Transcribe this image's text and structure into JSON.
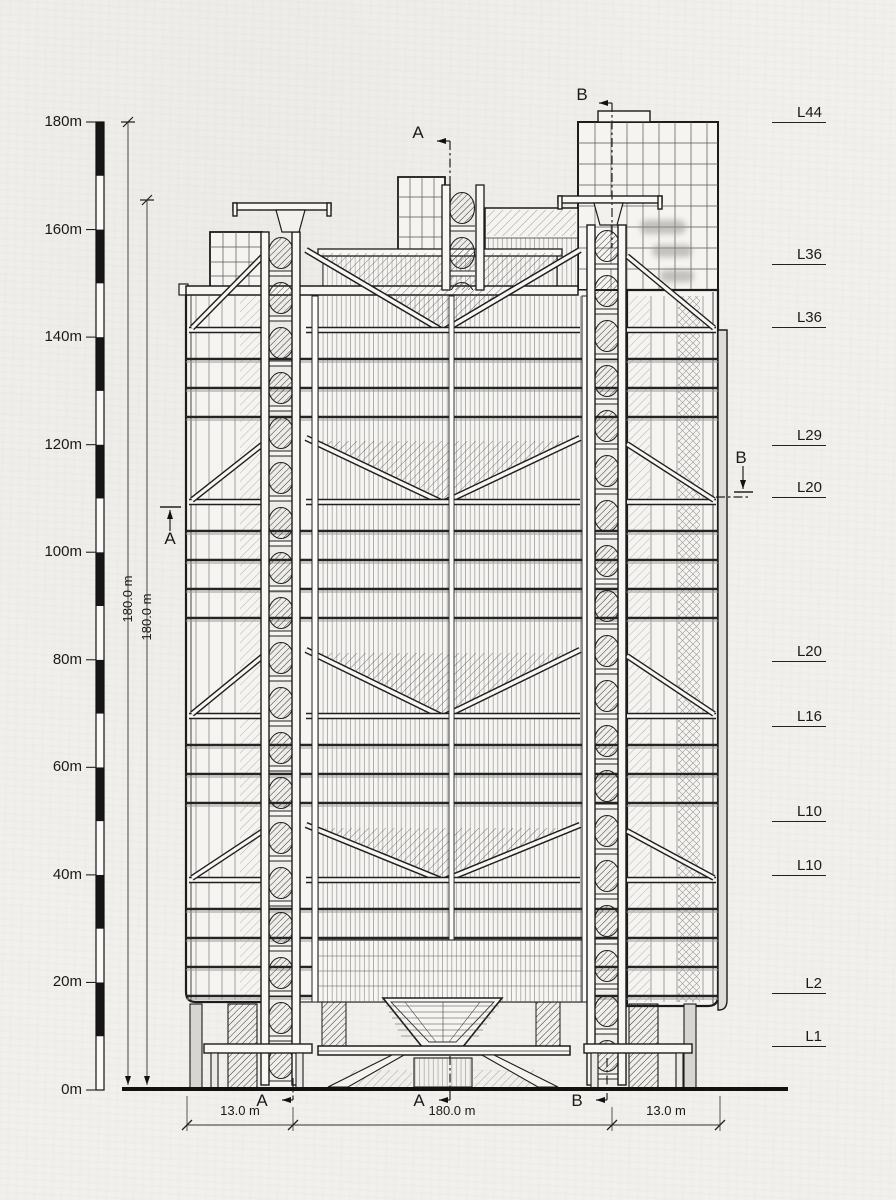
{
  "drawing": {
    "type": "architectural-elevation",
    "scale_bar": {
      "unit": "m",
      "max_m": 180,
      "band_m": 10,
      "labels": [
        {
          "text": "180m",
          "m": 180
        },
        {
          "text": "160m",
          "m": 160
        },
        {
          "text": "140m",
          "m": 140
        },
        {
          "text": "120m",
          "m": 120
        },
        {
          "text": "100m",
          "m": 100
        },
        {
          "text": "80m",
          "m": 80
        },
        {
          "text": "60m",
          "m": 60
        },
        {
          "text": "40m",
          "m": 40
        },
        {
          "text": "20m",
          "m": 20
        },
        {
          "text": "0m",
          "m": 0
        }
      ]
    },
    "height_dimensions": [
      {
        "text": "180.0 m"
      },
      {
        "text": "180.0 m"
      }
    ],
    "level_labels": [
      {
        "text": "L44",
        "y_px": 124
      },
      {
        "text": "L36",
        "y_px": 266
      },
      {
        "text": "L36",
        "y_px": 329
      },
      {
        "text": "L29",
        "y_px": 447
      },
      {
        "text": "L20",
        "y_px": 499
      },
      {
        "text": "L20",
        "y_px": 663
      },
      {
        "text": "L16",
        "y_px": 728
      },
      {
        "text": "L10",
        "y_px": 823
      },
      {
        "text": "L10",
        "y_px": 877
      },
      {
        "text": "L2",
        "y_px": 995
      },
      {
        "text": "L1",
        "y_px": 1048
      }
    ],
    "section_markers": [
      {
        "text": "A",
        "pos": "top-center"
      },
      {
        "text": "B",
        "pos": "top-right"
      },
      {
        "text": "A",
        "pos": "mid-left"
      },
      {
        "text": "B",
        "pos": "mid-right"
      },
      {
        "text": "A",
        "pos": "bottom-left-mast"
      },
      {
        "text": "A",
        "pos": "bottom-center"
      },
      {
        "text": "B",
        "pos": "bottom-right-mast"
      }
    ],
    "plan_dimensions": [
      {
        "text": "13.0 m"
      },
      {
        "text": "180.0 m"
      },
      {
        "text": "13.0 m"
      }
    ],
    "ink_color": "#1c1c1c",
    "paper_color": "#f1f0ec"
  }
}
